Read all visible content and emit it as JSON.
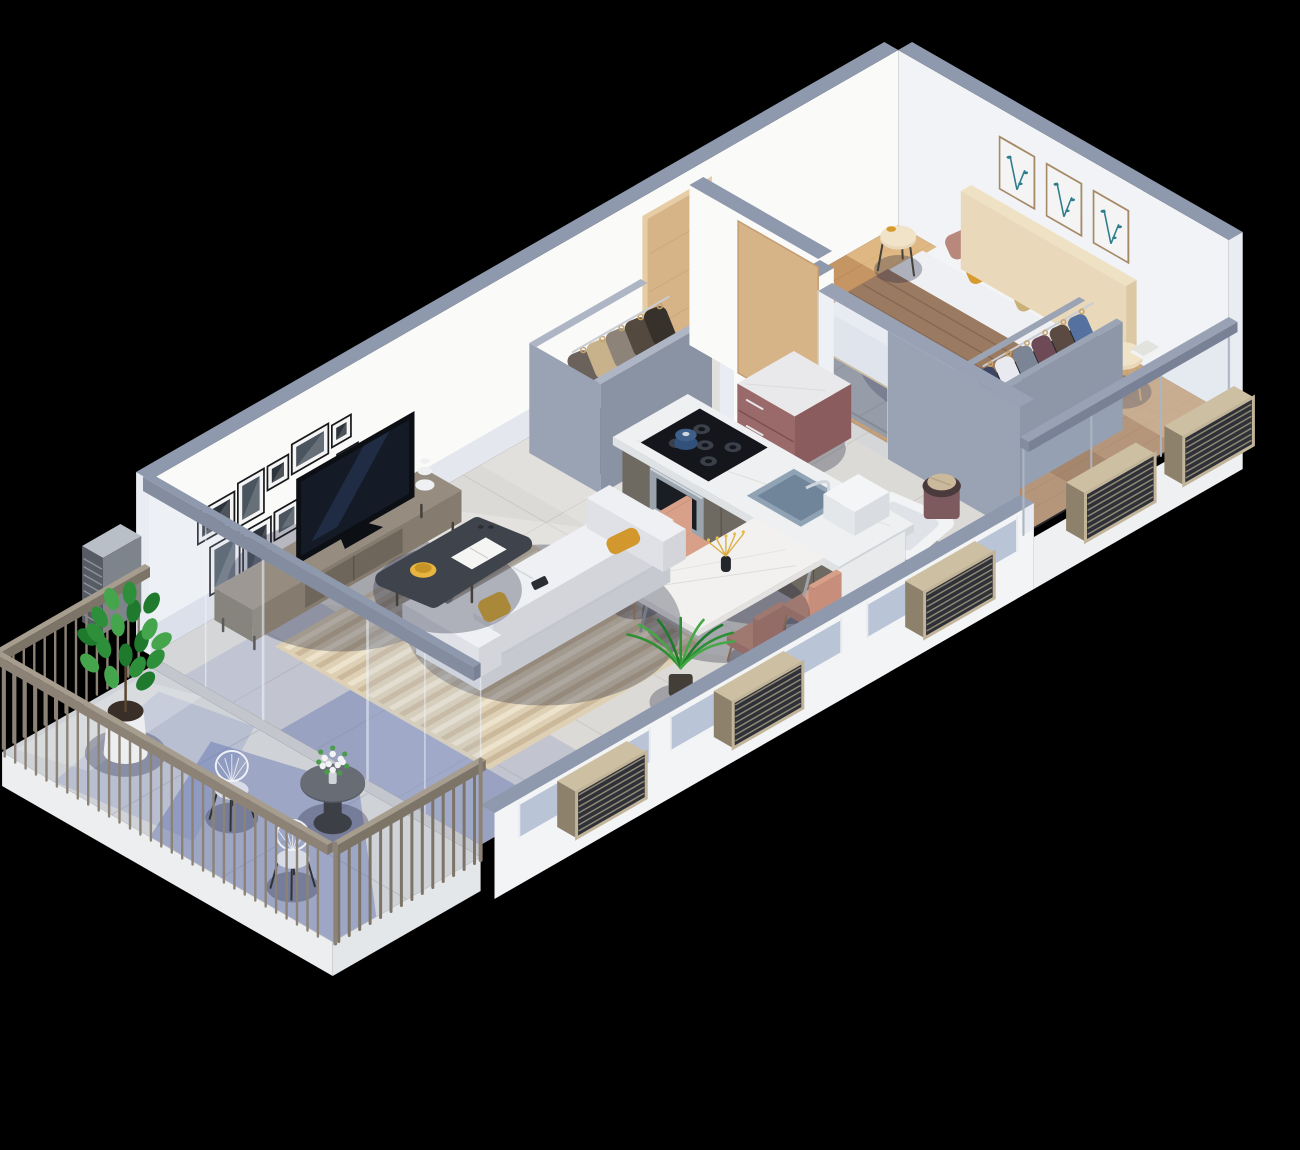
{
  "scene": {
    "type": "isometric-3d-floor-plan-render",
    "view": "isometric-cutaway-from-southwest",
    "background": "#000000",
    "apartment": {
      "rooms": [
        {
          "name": "living-room",
          "furniture": [
            "tv",
            "tv-console",
            "decor-sculpture",
            "sofa",
            "yellow-throw-pillows",
            "remote",
            "coffee-table",
            "yellow-bowl",
            "magazine",
            "striped-area-rug",
            "gallery-wall-frames"
          ]
        },
        {
          "name": "dining-area",
          "furniture": [
            "marble-dining-table",
            "blush-dining-chairs-x4",
            "vase-with-dried-flowers",
            "potted-palm"
          ]
        },
        {
          "name": "kitchen",
          "furniture": [
            "island-counter",
            "gas-cooktop",
            "blue-pot",
            "built-in-oven",
            "sink",
            "faucet",
            "dish-box",
            "appliance-cabinet"
          ]
        },
        {
          "name": "entry-hall",
          "furniture": [
            "wooden-front-door",
            "open-coat-closet",
            "hanging-coats"
          ]
        },
        {
          "name": "bathroom-utility",
          "furniture": [
            "wooden-sliding-doors",
            "glass-screen",
            "mauve-dresser",
            "laundry-basket",
            "bathtub"
          ]
        },
        {
          "name": "bedroom",
          "furniture": [
            "double-bed",
            "headboard",
            "pillow-stack",
            "brown-throw",
            "nightstand",
            "mosaic-globe-lamp",
            "books",
            "side-table",
            "open-wardrobe",
            "hanging-clothes",
            "gray-rug",
            "botanical-frames-x3",
            "wood-parquet-floor"
          ]
        },
        {
          "name": "balcony",
          "furniture": [
            "perimeter-railing",
            "potted-fig-plant",
            "bistro-table",
            "flower-bouquet",
            "wire-chairs-x2"
          ]
        }
      ],
      "exterior": [
        "louvered-radiator-units-x6",
        "glass-partition-to-balcony",
        "glass-balustrade-bedroom",
        "window-band",
        "cutaway-low-walls",
        "floor-slab"
      ]
    },
    "counts": {
      "gallery_wall_frames": 10,
      "botanical_frames": 3,
      "dining_chairs": 4,
      "radiators": 6
    }
  },
  "palette": {
    "bg": "#000000",
    "wallFace": "#fafaf9",
    "wallFaceNE": "#f1f3f6",
    "wallTop": "#8f99ad",
    "wallEnd": "#e9edf3",
    "wallShade": "rgba(150,165,200,0.22)",
    "doorFrame": "#e7cda6",
    "doorWood": "#d7b388",
    "doorGrain": "#c49c72",
    "handle": "#eef1f4",
    "frameBlack": "#17181b",
    "frameMat": "#f4f4f4",
    "photoA": "#4a5560",
    "photoB": "#2e343c",
    "woodFrame": "#a68a66",
    "artTeal": "#2f7d8a",
    "tile": "#dcdad6",
    "tileLine": "#c7c4c0",
    "shadowBlue": "rgba(88,108,185,0.20)",
    "shadowBlueDeep": "rgba(64,84,160,0.30)",
    "lightPool": "rgba(255,255,255,0.22)",
    "wood": "#c59663",
    "woodLine": "#a97a4b",
    "woodDark": "rgba(122,78,40,0.30)",
    "woodLight": "rgba(255,224,170,0.45)",
    "rugGray": "#8e939b",
    "rugGrayLine": "#777c84",
    "consoleTop": "#968d80",
    "consoleSW": "#7b7265",
    "consoleSE": "#857c6f",
    "consoleInset": "#6e665a",
    "legDark": "#44403a",
    "tvBlack": "#0c0f14",
    "tvScreen": "#141b27",
    "tvGlow": "rgba(90,120,200,0.18)",
    "sculpt": "#eef0f1",
    "rugBase": "#ddd0b4",
    "rugStripeA": "rgba(201,181,150,0.85)",
    "rugStripeB": "rgba(238,228,206,0.9)",
    "sofaTop": "#eef0f3",
    "sofaSide": "#dfe1e6",
    "sofaFront": "#d3d5db",
    "sofaBase": "#c6c9d0",
    "pillowYellow": "#e7b63c",
    "pillowMustard": "#d2982d",
    "remote": "#2b2e33",
    "ctTable": "#3f444c",
    "bowlYellow": "#e8b63e",
    "paper": "#f5f5f3",
    "marble": "#f2f1ef",
    "marbleEdge": "#e3e2e0",
    "vein": "#d9d8d6",
    "chairBlush": "#d8a088",
    "chairBlushDark": "#c78f7b",
    "chairLeg": "#b08a5e",
    "palmGreen": "#2f8f35",
    "palmGreen2": "#45a845",
    "palmGreen3": "#1f7a2e",
    "potDark": "#443e38",
    "cabSW": "#6e6961",
    "cabSE": "#5f5a52",
    "cabSeam": "#524d46",
    "counter": "#eef0f2",
    "counterEdge": "#dfe2e4",
    "counterSE": "#d2d6d9",
    "cooktop": "#14161c",
    "burner": "#3a3f4a",
    "potBlue": "#3e5f8a",
    "potBlueDark": "#31507a",
    "steel": "#9ba3ac",
    "ovenGlass": "#1a1d22",
    "sinkBasin": "#8fa3b5",
    "sinkDeep": "#70859a",
    "chrome": "#cfd6de",
    "applWhite": "#e8eaec",
    "closetShellSW": "#9aa3b4",
    "closetShellSE": "#8a93a4",
    "closetRim": "#aeb6c6",
    "closetDark": "#23262e",
    "rail": "#c9cdd4",
    "hanger": "#caa36b",
    "coat1": "#6b625c",
    "coat2": "#c7b28b",
    "coat3": "#8d8379",
    "coat4": "#54493f",
    "coat5": "#37312b",
    "mauve": "#9a6a6a",
    "mauveDark": "#8a5c5e",
    "mauveSeam": "#7c4f52",
    "dresserTop": "#e9e9ec",
    "basket": "#7c5a5e",
    "basketIn": "#4a3a3c",
    "cloth": "#cbb99b",
    "tubWhite": "#f2f3f5",
    "tubRim": "#dfe3e8",
    "bedBaseSW": "#cfb892",
    "bedBaseSE": "#c2ab84",
    "matTop": "#f3f4f6",
    "matSW": "#e3e6ea",
    "matSE": "#d7dbe1",
    "duvet": "#f4f5f7",
    "duvetSide": "#e9ecf0",
    "throw": "#9b7a62",
    "throwSide": "#8a6b55",
    "throwLine": "#7c5f4b",
    "headSW": "#e9d9ba",
    "headSE": "#dcc9a4",
    "headTop": "#efe1c4",
    "pTan": "#c9a671",
    "pMauve": "#b9887d",
    "pGray": "#aeb7c6",
    "pMustard": "#d79a2e",
    "pKhaki": "#c9b077",
    "standTop": "#f0e3c8",
    "standSide": "#e8d7b8",
    "lampGlobe": "#dfe4ee",
    "lampBlue": "#4a6fa5",
    "wrSE": "#8e97a8",
    "wrSW": "#7e8798",
    "wrRim": "#9ba4b4",
    "wrDark": "#22262e",
    "cl1": "#3c4663",
    "cl2": "#e8eaf0",
    "cl3": "#7c8595",
    "cl4": "#6e4a57",
    "cl5": "#5a4a41",
    "cl6": "#5571a0",
    "glass": "rgba(185,202,224,0.20)",
    "glassEdge": "rgba(240,246,252,0.55)",
    "glassRail": "#99a2b4",
    "glassRailSW": "#848da0",
    "glassRailSE": "#788196",
    "seWallWhite": "#f3f4f6",
    "windowBlue": "rgba(105,128,172,0.42)",
    "mullion": "#e8ebef",
    "slab": "#eef0f2",
    "radFrame": "#c2b499",
    "radDark": "#2e3138",
    "radSlat": "#9b917b",
    "radTopC": "#cdbfa2",
    "radEnd": "#8d816b",
    "radSteel": "#565b64",
    "radSteelSlat": "#9aa1aa",
    "radSteelTop": "#b9bfc7",
    "radSteelSide": "#7e848c",
    "railWood": "#8c8376",
    "railTop": "#a79d8e",
    "railShade": "#7d7468",
    "balcTile": "#cfd2d6",
    "balcLine": "#b9bcc1",
    "balcEdge": "#eceef0",
    "balcEdgeSE": "#e4e7ea",
    "balcStep": "#c3c7cd",
    "wirechair": "#eef1f5",
    "cushion": "#d7dce6",
    "tableTop": "#565b63",
    "metal": "#3c3f45",
    "flowerWhite": "#f2f3f5",
    "flowerGreen": "#4c9b4c",
    "contactShadow": "rgba(25,30,55,0.30)"
  }
}
